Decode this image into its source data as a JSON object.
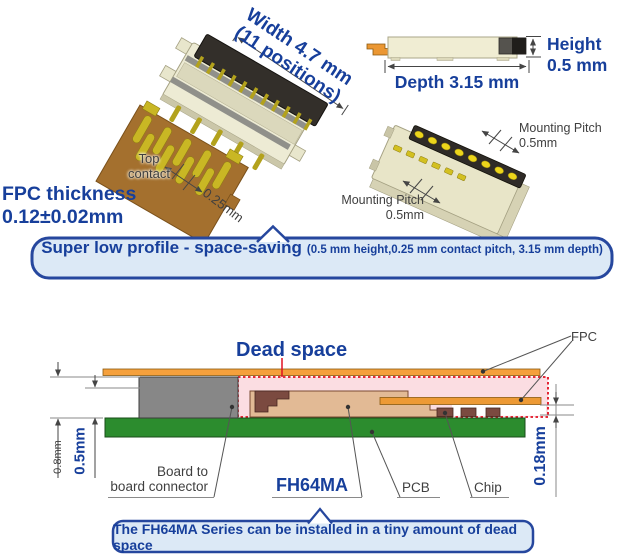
{
  "palette": {
    "blue_text": "#173f9b",
    "gray_text": "#3f3f3f",
    "callout_fill": "#dce9f6",
    "callout_border": "#26479e",
    "dead_space_pink": "#fbdde2",
    "dead_space_red": "#e01020",
    "fpc_orange": "#ed9a35",
    "pcb_green": "#2c8c2e",
    "connector_tan": "#e2ba95",
    "connector_cream": "#edebd4"
  },
  "top_view": {
    "width_line1": "Width 4.7 mm",
    "width_line2": "(11 positions)",
    "top_contact_line1": "Top",
    "top_contact_line2": "contact",
    "contact_pitch": "0.25mm",
    "fpc_thickness_line1": "FPC thickness",
    "fpc_thickness_line2": "0.12±0.02mm"
  },
  "side_view": {
    "height_line1": "Height",
    "height_line2": "0.5 mm",
    "depth": "Depth 3.15 mm"
  },
  "bottom_view": {
    "pitch_top_line1": "Mounting Pitch",
    "pitch_top_line2": "0.5mm",
    "pitch_bottom_line1": "Mounting Pitch",
    "pitch_bottom_line2": "0.5mm"
  },
  "feature_callout": {
    "main": "Super low profile - space-saving",
    "detail": "(0.5 mm height,0.25 mm contact pitch, 3.15 mm depth)"
  },
  "cross_section": {
    "dead_space": "Dead space",
    "fpc": "FPC",
    "stack_height": "0.8mm",
    "connector_height": "0.5mm",
    "clearance": "0.18mm",
    "b2b_line1": "Board to",
    "b2b_line2": "board connector",
    "series": "FH64MA",
    "pcb": "PCB",
    "chip": "Chip"
  },
  "bottom_callout": {
    "text": "The FH64MA Series can be installed in a tiny amount of dead space"
  }
}
